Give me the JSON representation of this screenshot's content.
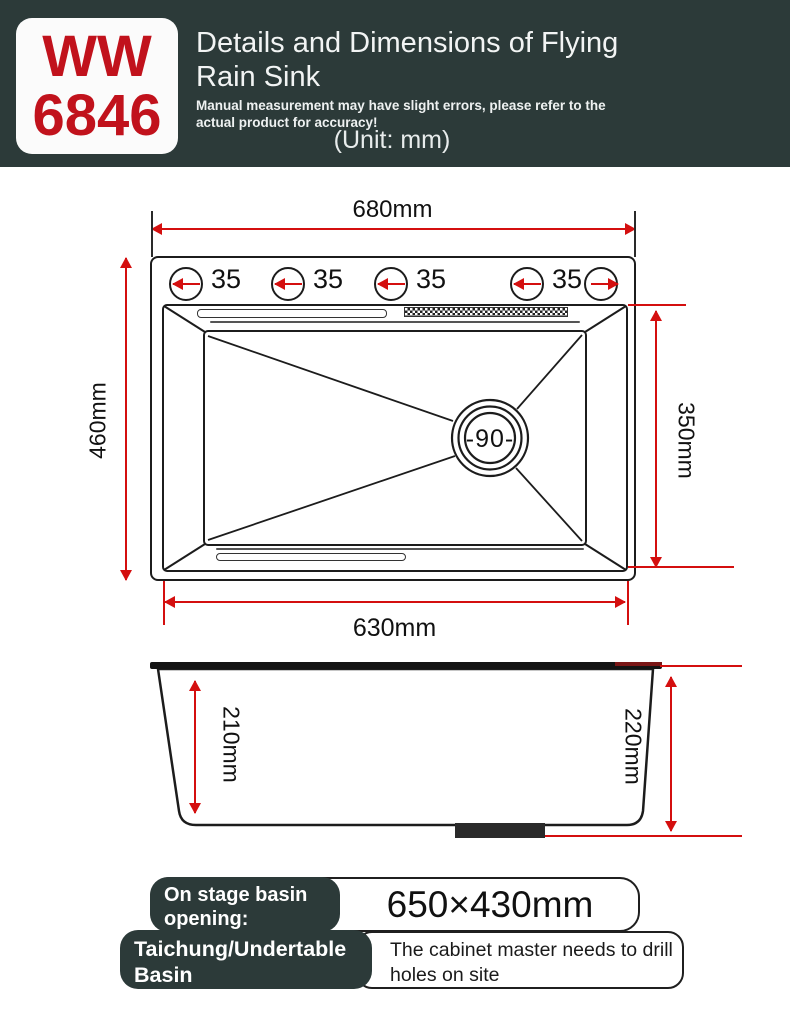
{
  "header": {
    "model_line1": "WW",
    "model_line2": "6846",
    "title": "Details and Dimensions of Flying Rain Sink",
    "disclaimer": "Manual measurement may have slight errors, please refer to the actual product for accuracy!",
    "unit_note": "(Unit: mm)"
  },
  "top_view": {
    "top_width": "680mm",
    "left_height": "460mm",
    "right_height": "350mm",
    "bottom_width": "630mm",
    "hole_labels": [
      "35",
      "35",
      "35",
      "35"
    ],
    "drain_label": "-90-"
  },
  "side_view": {
    "inner_depth": "210mm",
    "overall_height": "220mm"
  },
  "footer": {
    "row1": {
      "label_line1": "On stage basin",
      "label_line2": "opening:",
      "value": "650×430mm"
    },
    "row2": {
      "label_line1": "Taichung/Undertable Basin",
      "label_line2": "Openings:",
      "value_line1": "The cabinet master needs to drill",
      "value_line2": "holes on site"
    }
  },
  "colors": {
    "header_bg": "#2c3a39",
    "model_red": "#c1121c",
    "dim_red": "#d40f0f",
    "line": "#1c1c1c"
  }
}
